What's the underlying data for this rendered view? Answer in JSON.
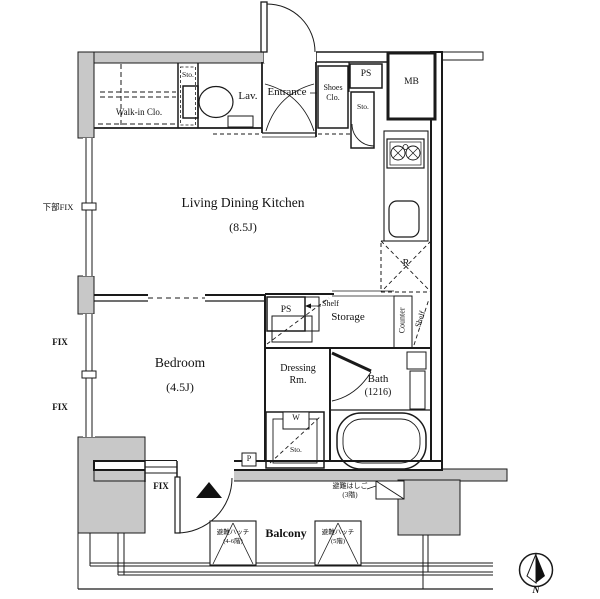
{
  "colors": {
    "wall_gray": "#c8c8c8",
    "line": "#1a1a1a",
    "bg": "#ffffff"
  },
  "labels": {
    "walk_in_closet": "Walk-in Clo.",
    "storage_top_small": "Sto.",
    "lavatory": "Lav.",
    "entrance": "Entrance",
    "shoes_closet_line1": "Shoes",
    "shoes_closet_line2": "Clo.",
    "pipe_space_top": "PS",
    "storage_right_small": "Sto.",
    "meter_box": "MB",
    "ldk_name": "Living Dining Kitchen",
    "ldk_size": "(8.5J)",
    "refrigerator": "R",
    "fix_lower_left": "下部FIX",
    "fix_left_1": "FIX",
    "fix_left_2": "FIX",
    "fix_bottom": "FIX",
    "pipe_space_mid": "PS",
    "shelf_mid": "Shelf",
    "storage_room": "Storage",
    "counter": "Counter",
    "shelf_side": "Shelf",
    "bedroom_name": "Bedroom",
    "bedroom_size": "(4.5J)",
    "dressing_line1": "Dressing",
    "dressing_line2": "Rm.",
    "bath_name": "Bath",
    "bath_size": "(1216)",
    "washer": "W",
    "washer_storage": "Sto.",
    "pole": "P",
    "balcony": "Balcony",
    "escape_ladder_line1": "避難はしご",
    "escape_ladder_line2": "(3階)",
    "escape_hatch1_line1": "避難ハッチ",
    "escape_hatch1_line2": "(4-6階)",
    "escape_hatch2_line1": "避難ハッチ",
    "escape_hatch2_line2": "(5階)",
    "compass_north": "N"
  }
}
